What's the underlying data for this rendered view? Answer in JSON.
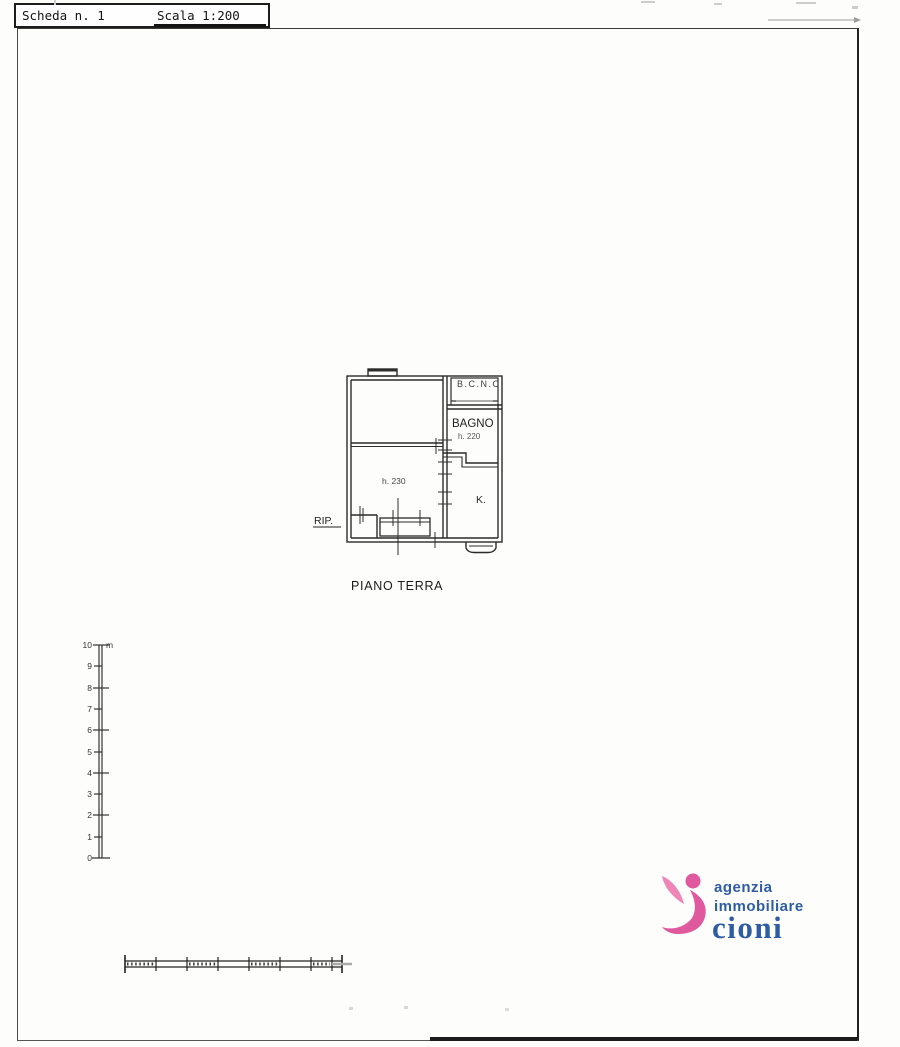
{
  "header": {
    "scheda": "Scheda n. 1",
    "scala": "Scala 1:200"
  },
  "floorplan": {
    "caption": "PIANO TERRA",
    "labels": {
      "bcnc": "B.C.N.C",
      "bagno": "BAGNO",
      "bagno_height": "h. 220",
      "main_room_height": "h. 230",
      "kitchen": "K.",
      "storage": "RIP."
    }
  },
  "ruler": {
    "unit": "m",
    "labels": [
      "10",
      "9",
      "8",
      "7",
      "6",
      "5",
      "4",
      "3",
      "2",
      "1",
      "0"
    ]
  },
  "logo": {
    "line1": "agenzia",
    "line2": "immobiliare",
    "line3": "cioni",
    "colors": {
      "blue": "#2e5da4",
      "pink_light": "#ee85b5",
      "pink_dark": "#e0589e"
    }
  }
}
